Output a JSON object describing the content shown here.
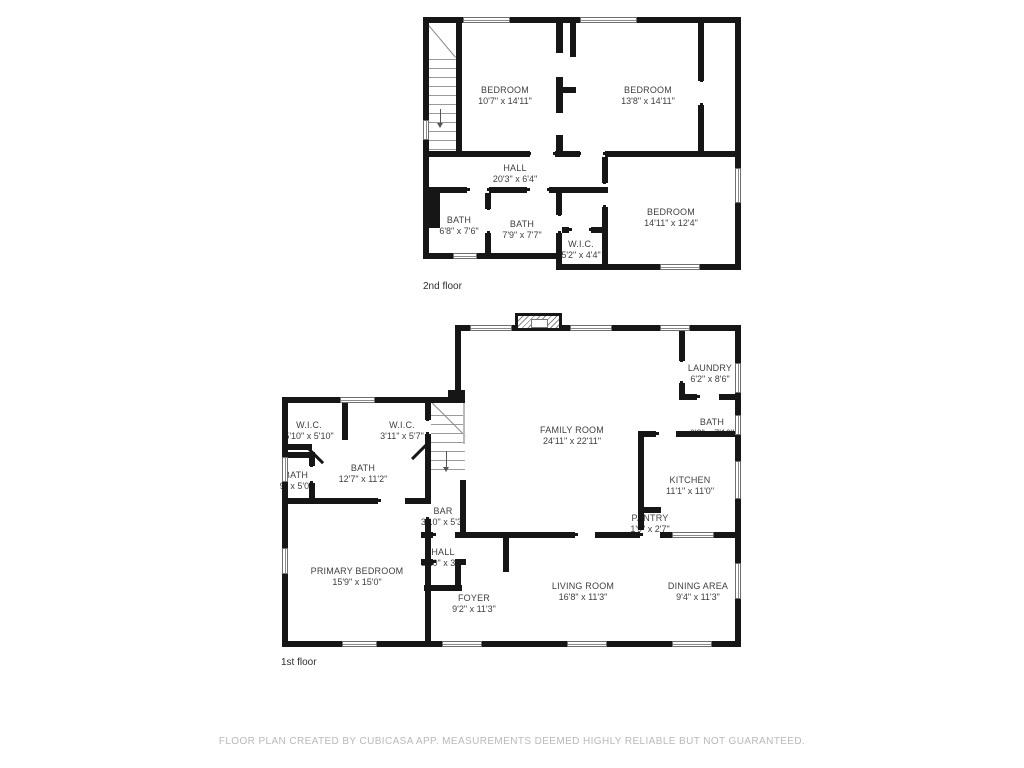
{
  "floors": {
    "second": {
      "label": "2nd floor",
      "rooms": {
        "bedroom1": {
          "name": "BEDROOM",
          "dims": "10'7\" x 14'11\""
        },
        "bedroom2": {
          "name": "BEDROOM",
          "dims": "13'8\" x 14'11\""
        },
        "hall": {
          "name": "HALL",
          "dims": "20'3\" x 6'4\""
        },
        "bath1": {
          "name": "BATH",
          "dims": "6'8\" x 7'6\""
        },
        "bath2": {
          "name": "BATH",
          "dims": "7'9\" x 7'7\""
        },
        "wic": {
          "name": "W.I.C.",
          "dims": "5'2\" x 4'4\""
        },
        "bedroom3": {
          "name": "BEDROOM",
          "dims": "14'11\" x 12'4\""
        }
      }
    },
    "first": {
      "label": "1st floor",
      "rooms": {
        "family": {
          "name": "FAMILY ROOM",
          "dims": "24'11\" x 22'11\""
        },
        "laundry": {
          "name": "LAUNDRY",
          "dims": "6'2\" x 8'6\""
        },
        "bath_upper": {
          "name": "BATH",
          "dims": "6'2\" x 7'10\""
        },
        "kitchen": {
          "name": "KITCHEN",
          "dims": "11'1\" x 11'0\""
        },
        "pantry": {
          "name": "PANTRY",
          "dims": "1'9\" x 2'7\""
        },
        "wic1": {
          "name": "W.I.C.",
          "dims": "5'10\" x 5'10\""
        },
        "wic2": {
          "name": "W.I.C.",
          "dims": "3'11\" x 5'7\""
        },
        "bath_main": {
          "name": "BATH",
          "dims": "12'7\" x 11'2\""
        },
        "bath_small": {
          "name": "BATH",
          "dims": "9\" x 5'0\""
        },
        "primary": {
          "name": "PRIMARY BEDROOM",
          "dims": "15'9\" x 15'0\""
        },
        "bar": {
          "name": "BAR",
          "dims": "3'10\" x 5'3\""
        },
        "hall": {
          "name": "HALL",
          "dims": "3'10\" x 3'4\""
        },
        "foyer": {
          "name": "FOYER",
          "dims": "9'2\" x 11'3\""
        },
        "living": {
          "name": "LIVING ROOM",
          "dims": "16'8\" x 11'3\""
        },
        "dining": {
          "name": "DINING AREA",
          "dims": "9'4\" x 11'3\""
        }
      }
    }
  },
  "footer": {
    "disclaimer": "FLOOR PLAN CREATED BY CUBICASA APP. MEASUREMENTS DEEMED HIGHLY RELIABLE BUT NOT GUARANTEED."
  },
  "colors": {
    "wall": "#161616",
    "label_text": "#3f3f3f",
    "disclaimer_text": "#b9b9b9",
    "background": "#ffffff"
  }
}
